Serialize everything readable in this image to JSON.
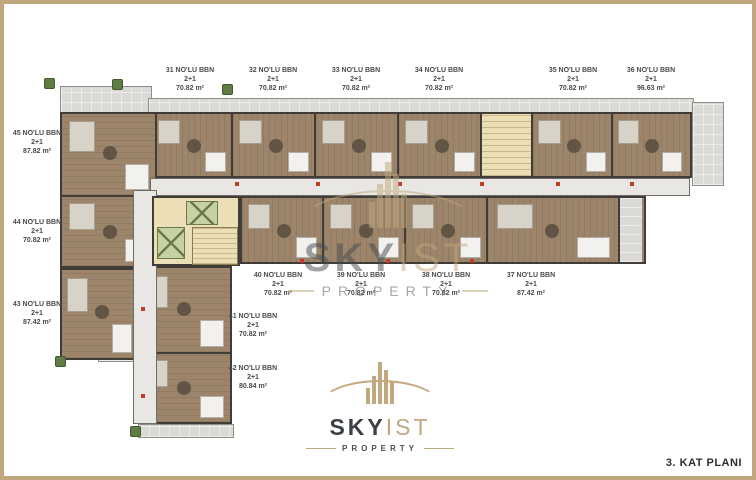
{
  "floor_plan": {
    "note": "3. KAT PLANI"
  },
  "brand": {
    "sky": "SKY",
    "ist": "IST",
    "property": "PROPERTY",
    "logo_icon": "skyscraper-bars"
  },
  "palette": {
    "accent_tan": "#c0a77e",
    "logo_dark": "#3c4148",
    "wood_floor": "#9c856a",
    "balcony_gray": "#dbdad6",
    "corridor_gray": "#e8e7e3",
    "wall_dark": "#403d38",
    "lift_green": "#c7d2a2",
    "stairs_tan": "#ecdfb6",
    "door_marker_red": "#c43a2e"
  },
  "units": [
    {
      "no": "31",
      "label": "31 NO'LU BBN",
      "type": "2+1",
      "area": "70.82 m²"
    },
    {
      "no": "32",
      "label": "32 NO'LU BBN",
      "type": "2+1",
      "area": "70.82 m²"
    },
    {
      "no": "33",
      "label": "33 NO'LU BBN",
      "type": "2+1",
      "area": "70.82 m²"
    },
    {
      "no": "34",
      "label": "34 NO'LU BBN",
      "type": "2+1",
      "area": "70.82 m²"
    },
    {
      "no": "35",
      "label": "35 NO'LU BBN",
      "type": "2+1",
      "area": "70.82 m²"
    },
    {
      "no": "36",
      "label": "36 NO'LU BBN",
      "type": "2+1",
      "area": "96.63 m²"
    },
    {
      "no": "37",
      "label": "37 NO'LU BBN",
      "type": "2+1",
      "area": "87.42 m²"
    },
    {
      "no": "38",
      "label": "38 NO'LU BBN",
      "type": "2+1",
      "area": "70.82 m²"
    },
    {
      "no": "39",
      "label": "39 NO'LU BBN",
      "type": "2+1",
      "area": "70.82 m²"
    },
    {
      "no": "40",
      "label": "40 NO'LU BBN",
      "type": "2+1",
      "area": "70.82 m²"
    },
    {
      "no": "41",
      "label": "41 NO'LU BBN",
      "type": "2+1",
      "area": "70.82 m²"
    },
    {
      "no": "42",
      "label": "42 NO'LU BBN",
      "type": "2+1",
      "area": "80.84 m²"
    },
    {
      "no": "43",
      "label": "43 NO'LU BBN",
      "type": "2+1",
      "area": "87.42 m²"
    },
    {
      "no": "44",
      "label": "44 NO'LU BBN",
      "type": "2+1",
      "area": "70.82 m²"
    },
    {
      "no": "45",
      "label": "45 NO'LU BBN",
      "type": "2+1",
      "area": "87.82 m²"
    }
  ]
}
